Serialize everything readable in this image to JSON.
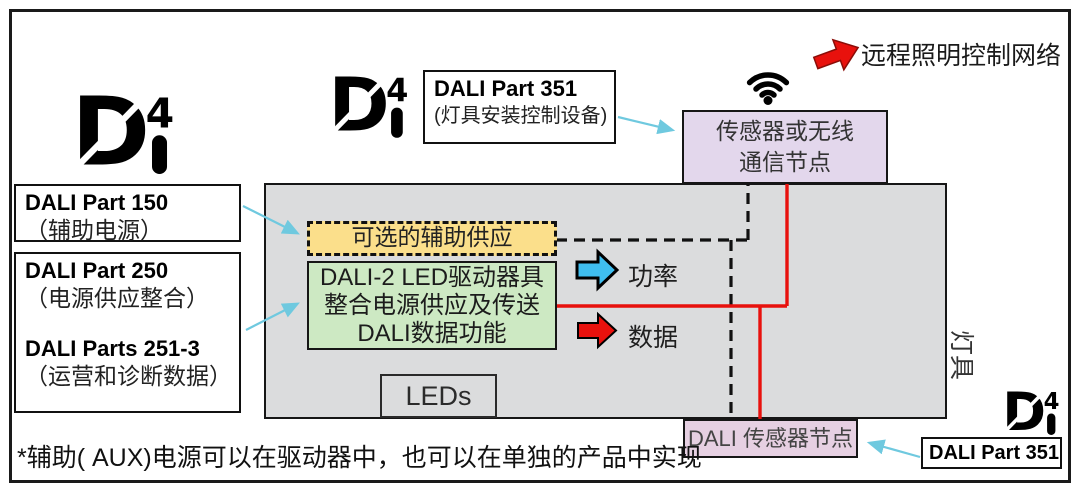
{
  "labels": {
    "part150_title": "DALI Part 150",
    "part150_sub": "（辅助电源）",
    "part250_title": "DALI Part 250",
    "part250_sub": "（电源供应整合）",
    "parts2513_title": "DALI Parts 251-3",
    "parts2513_sub": "（运营和诊断数据）",
    "part351_top_title": "DALI Part 351",
    "part351_top_sub": "(灯具安装控制设备)",
    "part351_bottom_title": "DALI Part 351"
  },
  "nodes": {
    "wireless_line1": "传感器或无线",
    "wireless_line2": "通信节点",
    "optional_aux": "可选的辅助供应",
    "driver_line1": "DALI-2 LED驱动器具",
    "driver_line2": "整合电源供应及传送",
    "driver_line3": "DALI数据功能",
    "leds": "LEDs",
    "sensor_node": "DALI 传感器节点",
    "luminaire": "灯具"
  },
  "arrows": {
    "remote_network": "远程照明控制网络",
    "power": "功率",
    "data": "数据"
  },
  "footnote": "*辅助( AUX)电源可以在驱动器中，也可以在单独的产品中实现",
  "logo": {
    "d_glyph": "D",
    "four_glyph": "4"
  },
  "colors": {
    "red_line": "#e8110d",
    "blue_arrow": "#3fbeef",
    "cyan_pointer": "#6fc9df",
    "yellow_box": "#fbdf8b",
    "green_box": "#cde9c3",
    "gray_box": "#dbdcdd",
    "purple_top": "#e3d7ec",
    "purple_bottom": "#e6d0e2"
  }
}
